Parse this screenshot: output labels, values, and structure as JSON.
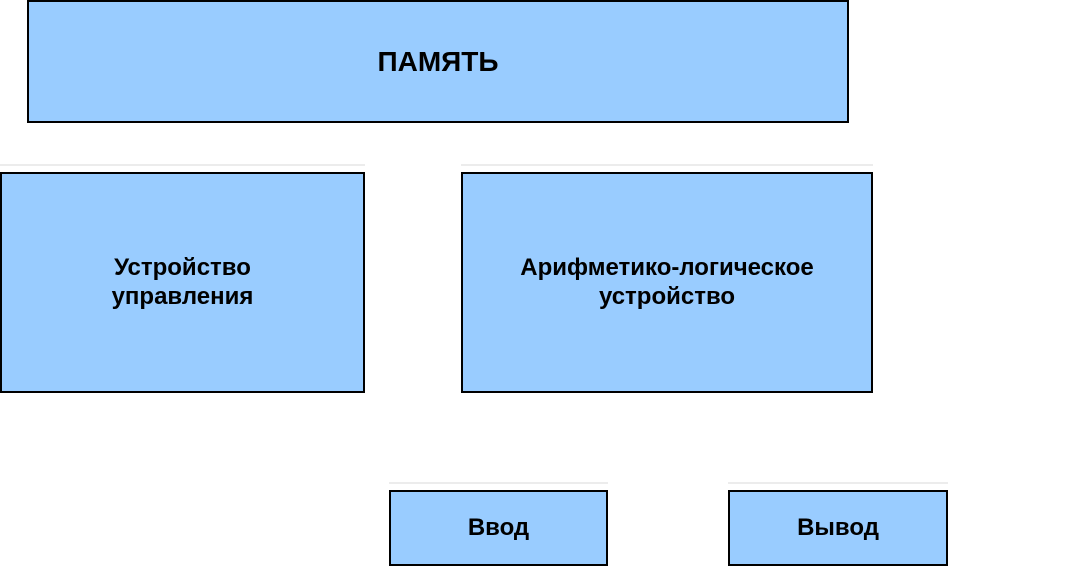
{
  "diagram": {
    "type": "block-diagram",
    "colors": {
      "box_fill": "#99CCFF",
      "box_border": "#000000",
      "text": "#000000",
      "background": "#FFFFFF"
    },
    "nodes": {
      "memory": {
        "label": "ПАМЯТЬ"
      },
      "control_unit": {
        "label": "Устройство\nуправления"
      },
      "alu": {
        "label": "Арифметико-логическое\nустройство"
      },
      "input": {
        "label": "Ввод"
      },
      "output": {
        "label": "Вывод"
      }
    }
  }
}
